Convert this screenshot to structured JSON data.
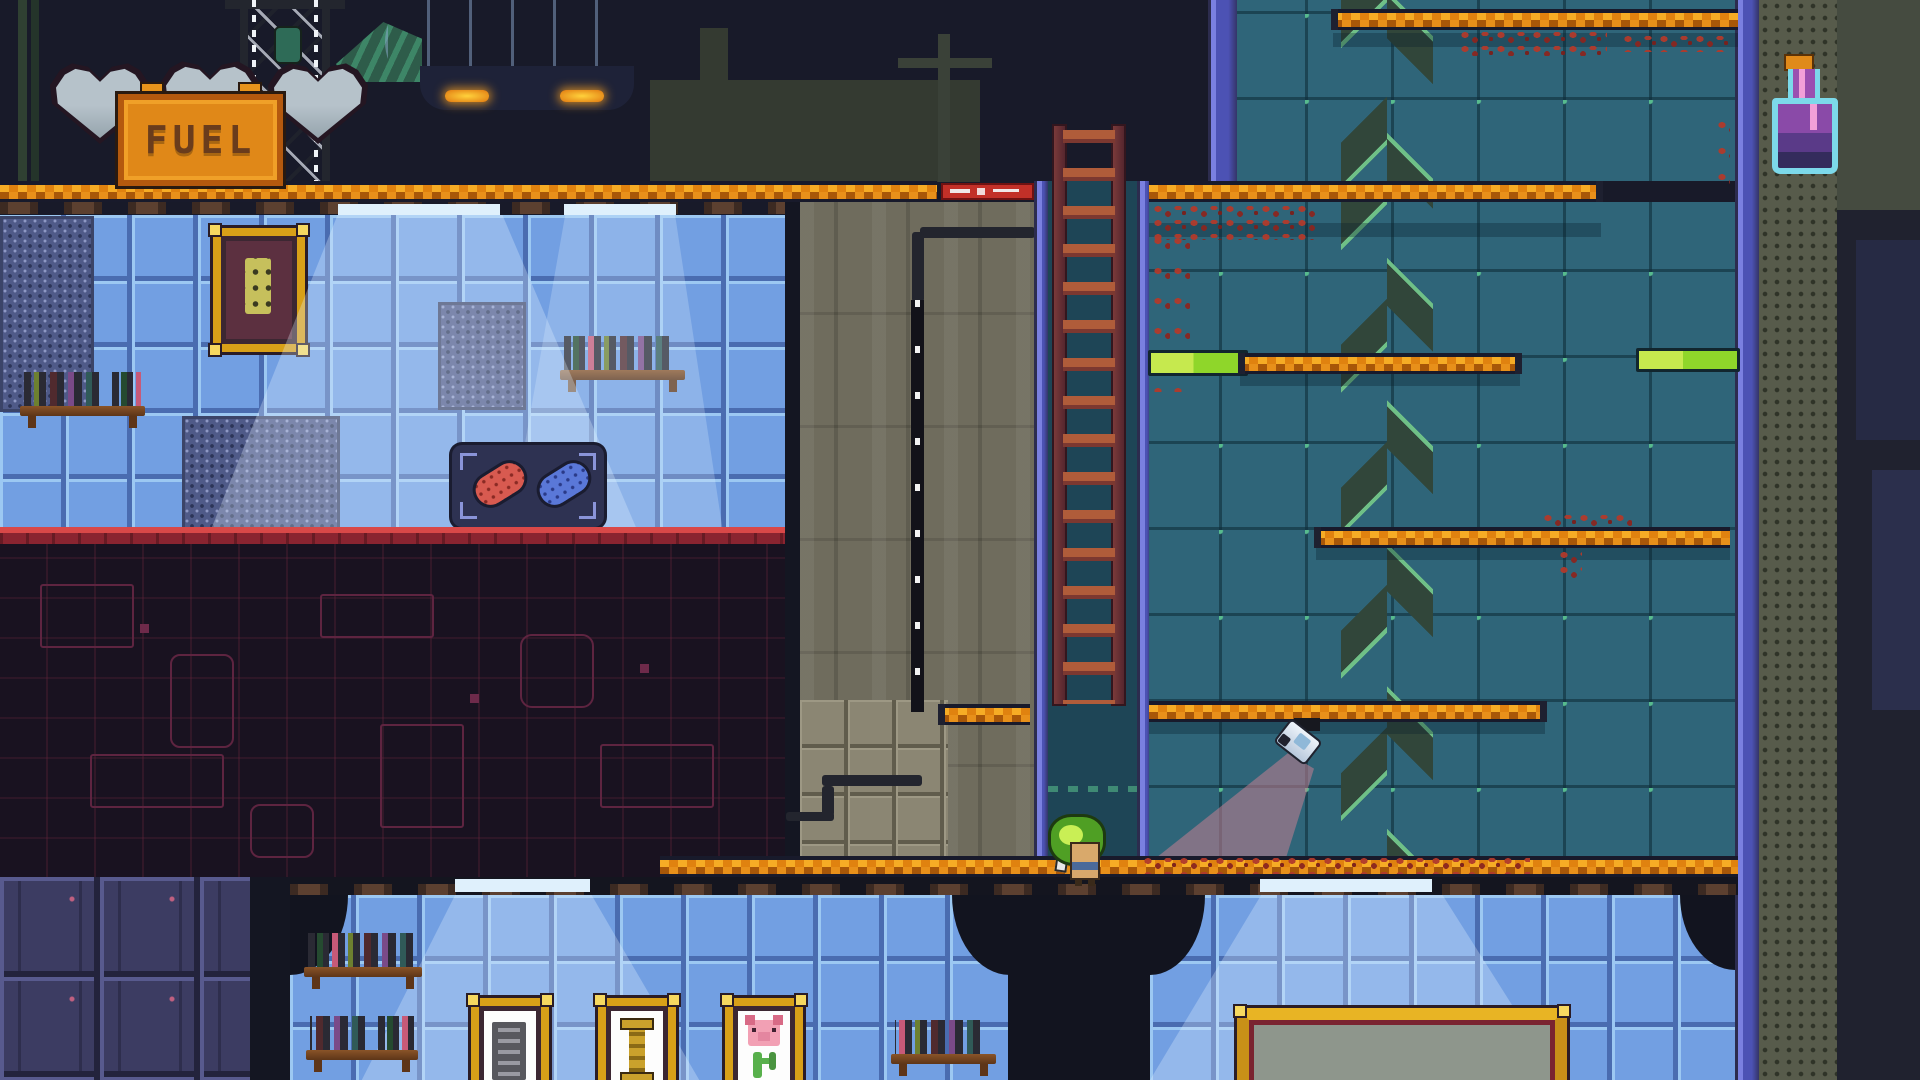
{
  "scene": {
    "type": "pixel-platformer",
    "view": "side-scroller"
  },
  "hud": {
    "fuel_sign": {
      "label": "FUEL",
      "color": "#e08818"
    },
    "hearts": {
      "count": 3,
      "state": "empty",
      "color": "#b6c2ca"
    }
  },
  "sprites": {
    "player": "sprout-hat-explorer",
    "camera": "surveillance-spotlight",
    "potion": "purple-flask",
    "display_case": [
      "red-pill",
      "blue-pill"
    ],
    "picture_frames": [
      "relic-chip",
      "golden-pillar",
      "pig-and-cactus"
    ],
    "big_frame": "gray-canvas",
    "airship": "white-blimp",
    "crane": "lattice-crane",
    "ladder": "wooden-ladder",
    "energy_bars": {
      "count": 2,
      "color": "#8fd62a"
    },
    "chevron_arrows": {
      "direction": "up",
      "color": "#31463a"
    }
  },
  "palette": {
    "sky": "#181a29",
    "platform_orange": "#f6ac25",
    "platform_edge": "#181a2b",
    "room_tile": "#729fe2",
    "teal_wall": "#2f6579",
    "grid_node_green": "#57bb8e",
    "circuit_wall": "#191220",
    "vine_red": "#b13a2c",
    "heart_gray": "#b6c2ca",
    "beam_pink": "rgba(197,128,145,0.55)"
  }
}
